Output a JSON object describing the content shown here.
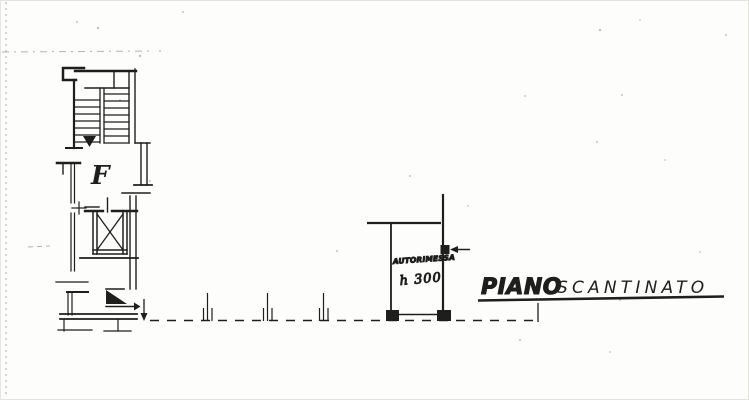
{
  "labels": {
    "stair": "F",
    "garage_name": "AUTORIMESSA",
    "garage_height": "h 300",
    "floor_title_word1": "PIANO",
    "floor_title_word2": "SCANTINATO"
  },
  "colors": {
    "ink": "#1e1e1c",
    "paper": "#fdfdfb",
    "scan_artifact": "#b2b2ac"
  }
}
